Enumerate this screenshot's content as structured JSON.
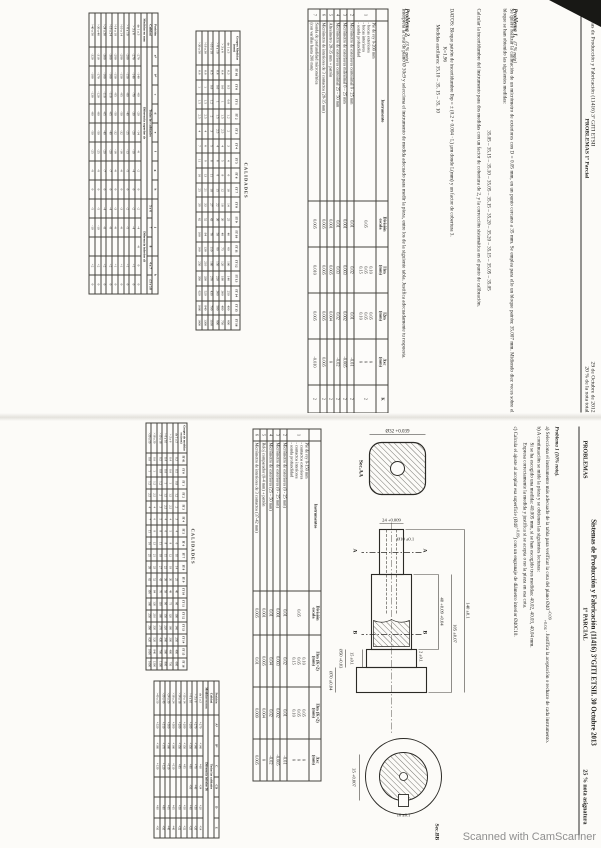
{
  "watermark": "Scanned with CamScanner",
  "page1": {
    "header": {
      "title": "Sistemas de Producción y Fabricación   (11416)  3º  GITI  ETSII",
      "date": "29 de Octubre de 2012",
      "subtitle": "PROBLEMAS 1º Parcial",
      "weight": "20 % de la nota total"
    },
    "problema1": {
      "label": "Problema 1.",
      "weight": "(7 % nota)",
      "p1": "Se quiere realizar la calibración de un micrómetro de exteriores con D = 0.05 mm, en un punto cercano a 35 mm. Se emplea para ello un bloque patrón: 35.007 mm. Midiendo diez veces sobre el bloque se han obtenido las siguientes medidas:",
      "medidas": "35.05 – 35.15 – 35.10 – 35.05 – 35.15 – 35.20 – 35.20 – 35.15 – 35.05 – 35.05",
      "p2": "Calcular la incertidumbre del instrumento para dos medidas con un factor de cobertura de 2, y la corrección sistemática en el punto de calibración."
    },
    "datos": {
      "line1": "DATOS: Bloque patrón de incertidumbre Ibp = ± (0.2 + 0.004 · L) µm donde L(mm) y un factor de cobertura 3.",
      "line2": "K=1.96",
      "line3": "Medidas auxiliares:     35.10 – 35. 15 – 35. 10"
    },
    "problema2": {
      "label": "Problema 2.",
      "weight": "(3 % nota)",
      "body": "Interpreta la cota de plano Ø 30c9 y selecciona el instrumento de medida adecuado para medir la pieza, entre los de la siguiente tabla.   Justifica adecuadamente tu respuesta."
    },
    "instrumentos": {
      "rows": [
        [
          {
            "t": "",
            "h": true
          },
          {
            "t": "Instrumento",
            "h": true
          },
          {
            "t": "División\nescala",
            "h": true
          },
          {
            "t": "I1m\n(mm)",
            "h": true
          },
          {
            "t": "I2m\n(mm)",
            "h": true
          },
          {
            "t": "Δxc\n(mm)",
            "h": true
          },
          {
            "t": "K",
            "h": true
          }
        ],
        [
          "1",
          "Pie de rey 0-200 mm\n- bocas exteriores\n- bocas interiores\n- sonda profundidad",
          "0.05",
          "0.10\n0.05\n0.15",
          "0.05\n0.05\n0.10",
          "0\n0\n0",
          "2"
        ],
        [
          "2",
          "Micrómetro de exteriores centesimal  0 - 25 mm",
          "0.01",
          "0.02",
          "0.01",
          "-0.01",
          "2"
        ],
        [
          "3",
          "Micrómetro de exteriores milesimal  0 – 25 mm",
          "0.001",
          "0.003",
          "0.002",
          "-0.005",
          "2"
        ],
        [
          "4",
          "Micrómetro de exteriores centesimal 25 – 50 mm",
          "0.01",
          "0.03",
          "0.02",
          "-0.02",
          "2"
        ],
        [
          "5",
          "Altesímetro 28-35 mm     + patrón",
          "0.001",
          "0.005",
          "0.004",
          "0",
          "2"
        ],
        [
          "6",
          "Micrómetro de interiores de 3 contactos  (28-35 mm)",
          "0.005",
          "0.005",
          "0.005",
          "0.005",
          "2"
        ],
        [
          "7",
          "Sonda de profundidad micrométrica\n(con varillas hasta 200 mm)",
          "0.005",
          "0.010",
          "0.005",
          "-0.010",
          "2"
        ]
      ]
    },
    "calidades": {
      "title": "CALIDADES",
      "rows": [
        [
          {
            "t": "Grupos Medidas (mm)",
            "h": true
          },
          {
            "t": "IT 01",
            "h": true
          },
          {
            "t": "IT 0",
            "h": true
          },
          {
            "t": "IT 1",
            "h": true
          },
          {
            "t": "IT 2",
            "h": true
          },
          {
            "t": "IT 3",
            "h": true
          },
          {
            "t": "IT 4",
            "h": true
          },
          {
            "t": "IT 5",
            "h": true
          },
          {
            "t": "IT 6",
            "h": true
          },
          {
            "t": "IT 7",
            "h": true
          },
          {
            "t": "IT 8",
            "h": true
          },
          {
            "t": "IT 9",
            "h": true
          },
          {
            "t": "IT 10",
            "h": true
          },
          {
            "t": "IT 11",
            "h": true
          },
          {
            "t": "IT 12",
            "h": true
          },
          {
            "t": "IT 13",
            "h": true
          },
          {
            "t": "IT 14",
            "h": true
          },
          {
            "t": "IT 15",
            "h": true
          },
          {
            "t": "IT 16",
            "h": true
          }
        ],
        [
          "de 1 a 3",
          "0.3",
          "0.5",
          "0.8",
          "1.2",
          "2",
          "3",
          "4",
          "6",
          "10",
          "14",
          "25",
          "40",
          "60",
          "100",
          "140",
          "250",
          "400",
          "600"
        ],
        [
          "> 3 a 6",
          "0.4",
          "0.6",
          "1",
          "1.5",
          "2.5",
          "4",
          "5",
          "8",
          "12",
          "18",
          "30",
          "48",
          "75",
          "120",
          "180",
          "300",
          "480",
          "750"
        ],
        [
          "> 6 a 10",
          "0.4",
          "0.6",
          "1",
          "1.5",
          "2.5",
          "4",
          "6",
          "9",
          "15",
          "22",
          "36",
          "58",
          "90",
          "150",
          "220",
          "360",
          "580",
          "900"
        ],
        [
          ">10 a 18",
          "0.5",
          "0.8",
          "1.2",
          "2",
          "3",
          "5",
          "8",
          "11",
          "18",
          "27",
          "43",
          "70",
          "110",
          "180",
          "270",
          "430",
          "700",
          "1100"
        ],
        [
          ">18 a 30",
          "0.6",
          "1",
          "1.5",
          "2.5",
          "4",
          "6",
          "9",
          "13",
          "21",
          "33",
          "52",
          "84",
          "130",
          "210",
          "330",
          "520",
          "840",
          "1300"
        ],
        [
          ">30 a 50",
          "0.6",
          "1",
          "1.5",
          "2.5",
          "4",
          "7",
          "11",
          "16",
          "25",
          "39",
          "62",
          "100",
          "160",
          "250",
          "390",
          "620",
          "1000",
          "1600"
        ]
      ]
    },
    "desviaciones": {
      "rows": [
        [
          {
            "t": "Posición",
            "h": true
          },
          {
            "t": "a*",
            "h": true
          },
          {
            "t": "b*",
            "h": true
          },
          {
            "t": "c",
            "h": true
          },
          {
            "t": "d",
            "h": true
          },
          {
            "t": "e",
            "h": true
          },
          {
            "t": "f",
            "h": true
          },
          {
            "t": "g",
            "h": true
          },
          {
            "t": "h",
            "h": true
          },
          {
            "t": "j",
            "h": true,
            "cs": 3
          },
          {
            "t": "k",
            "h": true,
            "cs": 2
          }
        ],
        [
          {
            "t": "Calidad",
            "h": true
          },
          {
            "t": "Todas las calidades",
            "h": true,
            "cs": 8
          },
          {
            "t": "5 y 6",
            "h": true
          },
          {
            "t": "7",
            "h": true
          },
          {
            "t": "8",
            "h": true
          },
          {
            "t": "4 a 7",
            "h": true
          },
          {
            "t": "≤3 y ≥8",
            "h": true
          }
        ],
        [
          {
            "t": "Medidas en mm",
            "h": true
          },
          {
            "t": "Diferencia superior ds",
            "h": true,
            "cs": 8
          },
          {
            "t": "Diferencia inferior di",
            "h": true,
            "cs": 5
          }
        ],
        [
          "de 1 a 3",
          "-270",
          "-140",
          "-60",
          "-20",
          "-14",
          "-6",
          "-2",
          "0",
          "-2",
          "-4",
          "-6",
          "0",
          "0"
        ],
        [
          "> 3 a 6",
          "-270",
          "-140",
          "-70",
          "-30",
          "-20",
          "-10",
          "-4",
          "0",
          "-2",
          "-4",
          "",
          "+1",
          "0"
        ],
        [
          "> 6 a 10",
          "-280",
          "-150",
          "-80",
          "-40",
          "-25",
          "-13",
          "-5",
          "0",
          "-2",
          "-5",
          "",
          "+1",
          "0"
        ],
        [
          ">10 a 14",
          "-290",
          "-150",
          "-95",
          "-50",
          "-32",
          "-16",
          "-6",
          "0",
          "-3",
          "-6",
          "",
          "+1",
          "0"
        ],
        [
          ">14 a 18",
          "-290",
          "-150",
          "-95",
          "-50",
          "-32",
          "-16",
          "-6",
          "0",
          "-3",
          "-6",
          "",
          "+1",
          "0"
        ],
        [
          ">18 a 24",
          "-300",
          "-160",
          "-110",
          "-65",
          "-40",
          "-20",
          "-7",
          "0",
          "-4",
          "-8",
          "",
          "+2",
          "0"
        ],
        [
          ">24 a 30",
          "-300",
          "-160",
          "-110",
          "-65",
          "-40",
          "-20",
          "-7",
          "0",
          "-4",
          "-8",
          "",
          "+2",
          "0"
        ],
        [
          ">30 a 40",
          "-310",
          "-170",
          "-120",
          "-80",
          "-50",
          "-25",
          "-9",
          "0",
          "-5",
          "-10",
          "",
          "+2",
          "0"
        ],
        [
          ">40 a 50",
          "-320",
          "-180",
          "-130",
          "-80",
          "-50",
          "-25",
          "-9",
          "0",
          "-5",
          "-10",
          "",
          "+2",
          "0"
        ]
      ]
    }
  },
  "page2": {
    "header": {
      "title": "Sistemas de Producción y Fabricación (11416) 3ºGITI ETSII. 30 Octubre 2013",
      "left": "PROBLEMAS",
      "center": "1º PARCIAL",
      "right": "25 % nota asignatura"
    },
    "problema1": {
      "label": "Problema 1 (10% nota).",
      "a_pre": "a)  Selecciona el instrumento más adecuado de la tabla para verificar la cota del plano Ø40",
      "a_sup": "+0.09",
      "a_sub": "+0.04",
      "a_post": " . Justifica la aceptación o rechazo de cada instrumento.",
      "b1": "b)  A continuación se mide la pieza y se obtienen las siguientes lecturas:",
      "b2": "Si se ha escogido una medida: 40.005 mm,  si se han escogido tres medidas:   40.02, 40.03, 40.04 mm.",
      "b3": "Expresa correctamente la medida y justifica si se acepta o no la pieza en esa cota.",
      "c_pre": "c)  Calcula el ajuste al acoplar esa superficie (Ø40",
      "c_sup": "+0.09",
      "c_post": ") con un engranaje de diámetro interior  Ø40C10."
    },
    "drawing": {
      "sec_aa": "Sec.AA",
      "sec_bb": "Sec.BB",
      "d32": "Ø32 +0.039",
      "d24": "24 +0.009",
      "d10": "Ø10 ±0.1",
      "d40": "40 +0.09 +0.04",
      "d105": "105 ±0.07",
      "d140": "140 ±0.1",
      "d2": "2 ±0.1",
      "d15": "15 ±0.1",
      "d50": "Ø50 +0.03",
      "d70": "Ø70 ±0.04",
      "d35": "35 +0.007",
      "dkw": "10 ±0.1",
      "cut_a1": "A",
      "cut_a2": "A",
      "cut_b1": "B",
      "cut_b2": "B"
    },
    "instrumentos": {
      "rows": [
        [
          {
            "t": "",
            "h": true
          },
          {
            "t": "Instrumentos",
            "h": true
          },
          {
            "t": "División\nescala",
            "h": true
          },
          {
            "t": "I1m (K=2)\n(mm)",
            "h": true
          },
          {
            "t": "I3m (K=2)\n(mm)",
            "h": true
          },
          {
            "t": "Δxc\n(mm)",
            "h": true
          }
        ],
        [
          "1",
          "Pie de rey 0-150 mm\n- contactos exteriores\n- contactos interiores\n- sonda profundidad",
          "0.05",
          "0.10\n0.05\n0.15",
          "0.05\n0.05\n0.10",
          "0\n0\n0"
        ],
        [
          "2",
          "Micrómetro de exteriores (0 - 25 mm)",
          "0.01",
          "0.02",
          "0.01",
          "-0.01"
        ],
        [
          "3",
          "Micrómetro de exteriores (0 - 25 mm)",
          "0.001",
          "0.003",
          "0.002",
          "-0.005"
        ],
        [
          "4",
          "Micrómetro de exteriores  (25 – 50 mm)",
          "0.01",
          "0.04",
          "0.02",
          "-0.02"
        ],
        [
          "5",
          "Reloj comparador (0-4 mm)    + patrón",
          "0.001",
          "0.005",
          "0.004",
          "0"
        ],
        [
          "6",
          "Micrómetro de interiores de 3 contactos  (37-42 mm)",
          "0.005",
          "0.01",
          "0.009",
          "0.005"
        ]
      ]
    },
    "calidades": {
      "title": "CALIDADES",
      "rows": [
        [
          {
            "t": "Grupos de medidas en (mm)",
            "h": true
          },
          {
            "t": "IT 01",
            "h": true
          },
          {
            "t": "IT 0",
            "h": true
          },
          {
            "t": "IT 1",
            "h": true
          },
          {
            "t": "IT 2",
            "h": true
          },
          {
            "t": "IT 3",
            "h": true
          },
          {
            "t": "IT 4",
            "h": true
          },
          {
            "t": "IT 5",
            "h": true
          },
          {
            "t": "IT 6",
            "h": true
          },
          {
            "t": "IT 7",
            "h": true
          },
          {
            "t": "IT 8",
            "h": true
          },
          {
            "t": "IT 9",
            "h": true
          },
          {
            "t": "IT 10",
            "h": true
          },
          {
            "t": "IT 11",
            "h": true
          },
          {
            "t": "IT 12",
            "h": true
          },
          {
            "t": "IT 13",
            "h": true
          },
          {
            "t": "IT 14",
            "h": true
          },
          {
            "t": "IT 15",
            "h": true
          },
          {
            "t": "IT 16",
            "h": true
          }
        ],
        [
          "de 1 a 3",
          "0.3",
          "0.5",
          "0.8",
          "1.2",
          "2",
          "3",
          "4",
          "6",
          "10",
          "14",
          "25",
          "40",
          "60",
          "100",
          "140",
          "250",
          "400",
          "600"
        ],
        [
          "> 3 a 6",
          "0.4",
          "0.6",
          "1",
          "1.5",
          "2.5",
          "4",
          "5",
          "8",
          "12",
          "18",
          "30",
          "48",
          "75",
          "120",
          "180",
          "300",
          "480",
          "750"
        ],
        [
          "> 6 a 10",
          "0.4",
          "0.6",
          "1",
          "1.5",
          "2.5",
          "4",
          "6",
          "9",
          "15",
          "22",
          "36",
          "58",
          "90",
          "150",
          "220",
          "360",
          "580",
          "900"
        ],
        [
          ">10 a 18",
          "0.5",
          "0.8",
          "1.2",
          "2",
          "3",
          "5",
          "8",
          "11",
          "18",
          "27",
          "43",
          "70",
          "110",
          "180",
          "270",
          "430",
          "700",
          "1100"
        ],
        [
          ">18 a 30",
          "0.6",
          "1",
          "1.5",
          "2.5",
          "4",
          "6",
          "9",
          "13",
          "21",
          "33",
          "52",
          "84",
          "130",
          "210",
          "330",
          "520",
          "840",
          "1300"
        ],
        [
          ">30 a 50",
          "0.6",
          "1",
          "1.5",
          "2.5",
          "4",
          "7",
          "11",
          "16",
          "25",
          "39",
          "62",
          "100",
          "160",
          "250",
          "390",
          "620",
          "1000",
          "1600"
        ]
      ]
    },
    "desviaciones": {
      "rows": [
        [
          {
            "t": "Posición",
            "h": true
          },
          {
            "t": "A*",
            "h": true
          },
          {
            "t": "B*",
            "h": true
          },
          {
            "t": "C",
            "h": true
          },
          {
            "t": "CD",
            "h": true
          },
          {
            "t": "D",
            "h": true
          },
          {
            "t": "E",
            "h": true
          }
        ],
        [
          {
            "t": "Calidad",
            "h": true
          },
          {
            "t": "Todas las calidades",
            "h": true,
            "cs": 6
          }
        ],
        [
          {
            "t": "Medidas en mm",
            "h": true
          },
          {
            "t": "Diferencia inferior Di",
            "h": true,
            "cs": 6
          }
        ],
        [
          "de 1 a 3",
          "+270",
          "+140",
          "+60",
          "+34",
          "+20",
          "+14"
        ],
        [
          "> 3 a 6",
          "+270",
          "+140",
          "+70",
          "+46",
          "+30",
          "+20"
        ],
        [
          "> 6 a 10",
          "+280",
          "+150",
          "+80",
          "+56",
          "+40",
          "+25"
        ],
        [
          ">10 a 14",
          "+290",
          "+150",
          "+95",
          "",
          "+50",
          "+32"
        ],
        [
          ">14 a 18",
          "+290",
          "+150",
          "+95",
          "",
          "+50",
          "+32"
        ],
        [
          ">18 a 24",
          "+300",
          "+160",
          "+110",
          "",
          "+65",
          "+40"
        ],
        [
          ">24 a 30",
          "+300",
          "+160",
          "+110",
          "",
          "+65",
          "+40"
        ],
        [
          ">30 a 40",
          "+310",
          "+170",
          "+120",
          "",
          "+80",
          "+50"
        ],
        [
          ">40 a 50",
          "+320",
          "+180",
          "+130",
          "",
          "+80",
          "+50"
        ]
      ]
    }
  }
}
